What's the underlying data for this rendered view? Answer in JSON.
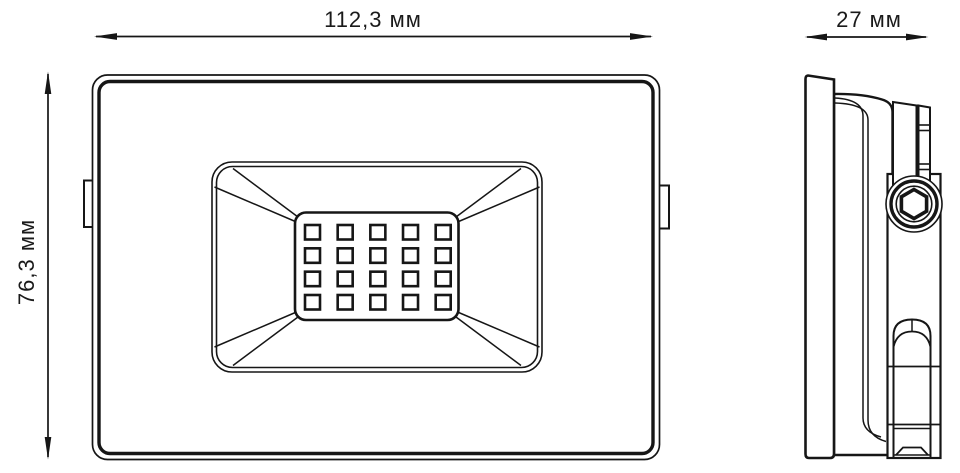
{
  "dimensions": {
    "width_label": "112,3 мм",
    "depth_label": "27 мм",
    "height_label": "76,3 мм"
  },
  "front_view": {
    "led_grid": {
      "rows": 4,
      "cols": 5
    }
  },
  "colors": {
    "line": "#161616",
    "background": "#ffffff"
  }
}
